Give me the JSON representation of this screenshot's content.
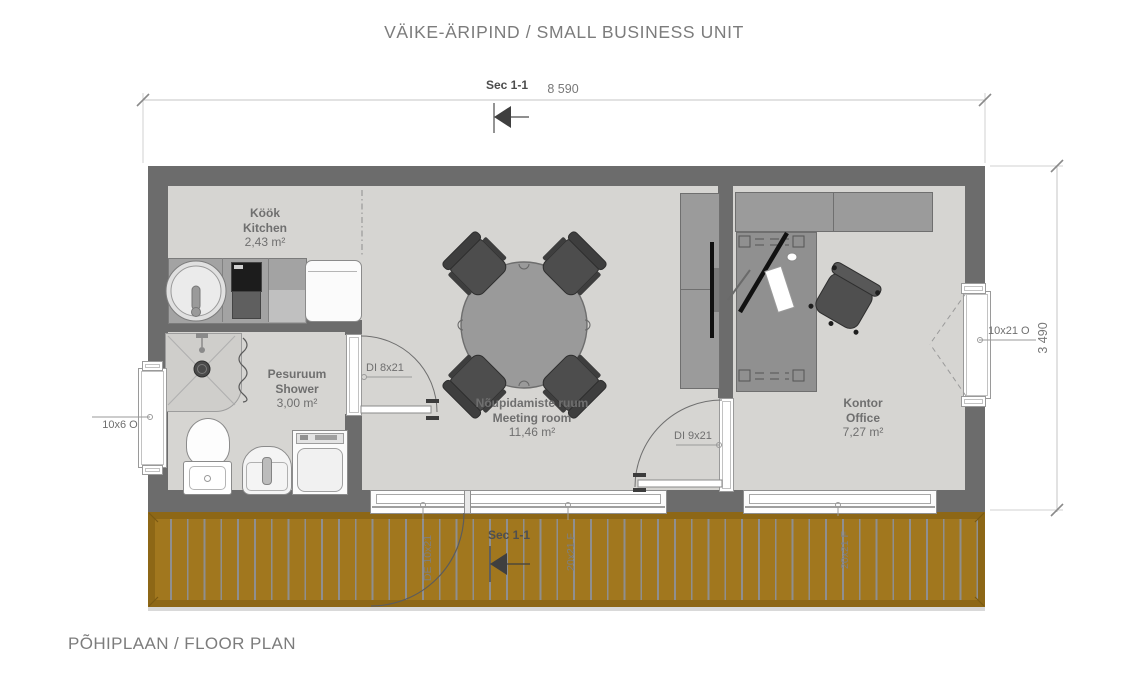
{
  "title": "VÄIKE-ÄRIPIND / SMALL BUSINESS UNIT",
  "footer": "PÕHIPLAAN / FLOOR PLAN",
  "dimensions": {
    "width": "8 590",
    "height": "3 490"
  },
  "section_markers": {
    "top": "Sec 1-1",
    "bottom": "Sec 1-1"
  },
  "rooms": {
    "kitchen": {
      "name_local": "Köök",
      "name_en": "Kitchen",
      "area": "2,43 m²"
    },
    "shower": {
      "name_local": "Pesuruum",
      "name_en": "Shower",
      "area": "3,00 m²"
    },
    "meeting_room": {
      "name_local": "Nõupidamiste ruum",
      "name_en": "Meeting room",
      "area": "11,46 m²"
    },
    "office": {
      "name_local": "Kontor",
      "name_en": "Office",
      "area": "7,27 m²"
    }
  },
  "openings": {
    "left_window": "10x6 O",
    "shower_door": "DI 8x21",
    "office_door": "DI 9x21",
    "right_door": "10x21 O",
    "deck_door": "DE 10x21",
    "meeting_window": "20x21 F",
    "office_window": "20x21 F"
  },
  "colors": {
    "wall": "#6c6c6c",
    "floor": "#d6d5d2",
    "deck": "#a1771e",
    "deck_frame": "#8d6716",
    "furniture": "#9b9b9b",
    "chair": "#4d4d4d",
    "dimension_text": "#787878"
  }
}
